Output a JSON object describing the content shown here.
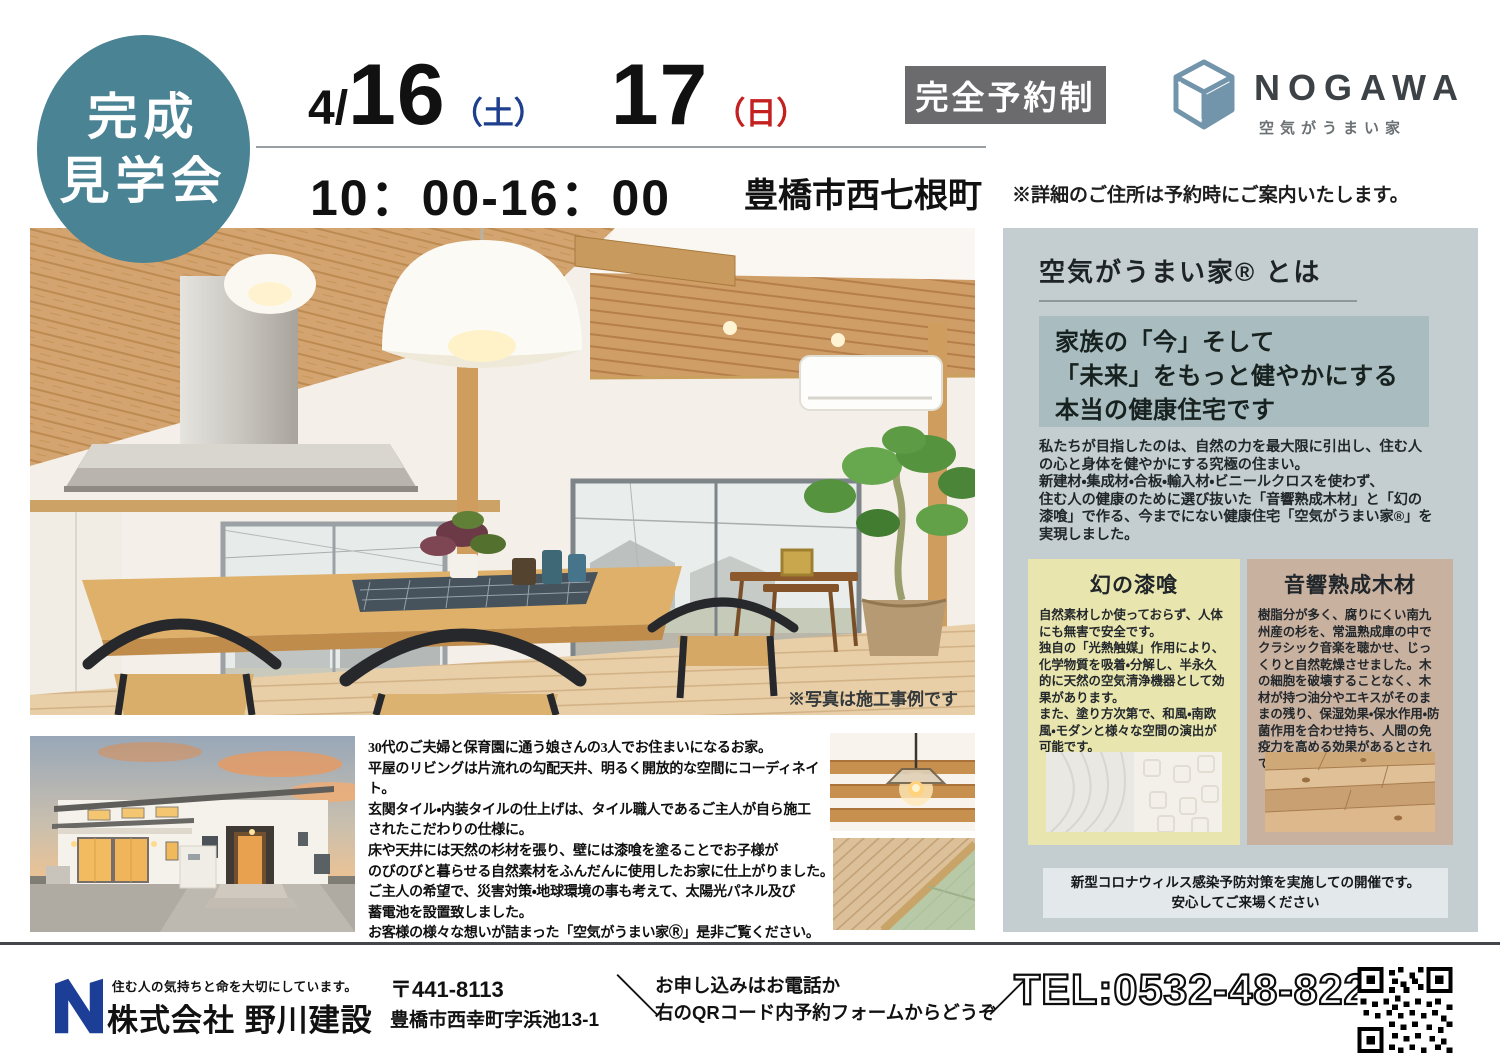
{
  "colors": {
    "teal_circle": "#4a8394",
    "saturday_blue": "#1e3f8e",
    "sunday_red": "#c4201f",
    "badge_gray": "#6b6b6d",
    "panel_bg": "#c4ced1",
    "panel_lead_bg": "#a9bdc0",
    "plaster_box": "#e9e5ae",
    "wood_box": "#c9b1a0",
    "logo_steel_blue": "#7295ab",
    "footer_navy": "#1c3e96"
  },
  "event": {
    "circle_line1": "完成",
    "circle_line2": "見学会",
    "date_month": "4/",
    "date_day1": "16",
    "date_day1_weekday": "（土）",
    "date_day2": "17",
    "date_day2_weekday": "（日）",
    "reservation_badge": "完全予約制",
    "time": "10：00-16：00",
    "location": "豊橋市西七根町",
    "location_note": "※詳細のご住所は予約時にご案内いたします。"
  },
  "logo": {
    "name": "NOGAWA",
    "tagline": "空気がうまい家",
    "icon": "nogawa-cube-icon"
  },
  "main_photo": {
    "caption": "※写真は施工事例です"
  },
  "panel": {
    "heading": "空気がうまい家®  とは",
    "lead": [
      "家族の「今」そして",
      "「未来」をもっと健やかにする",
      "本当の健康住宅です"
    ],
    "body": "私たちが目指したのは、自然の力を最大限に引出し、住む人\nの心と身体を健やかにする究極の住まい。\n新建材・集成材・合板・輸入材・ビニールクロスを使わず、\n住む人の健康のために選び抜いた「音響熟成木材」と「幻の\n漆喰」で作る、今までにない健康住宅「空気がうまい家®」を\n実現しました。",
    "materials": [
      {
        "title": "幻の漆喰",
        "body": "自然素材しか使っておらず、人体にも無害で安全です。\n独自の「光熱触媒」作用により、化学物質を吸着・分解し、半永久的に天然の空気清浄機器として効果があります。\nまた、塗り方次第で、和風・南欧風・モダンと様々な空間の演出が可能です。"
      },
      {
        "title": "音響熟成木材",
        "body": "樹脂分が多く、腐りにくい南九州産の杉を、常温熟成庫の中でクラシック音楽を聴かせ、じっくりと自然乾燥させました。木の細胞を破壊することなく、木材が持つ油分やエキスがそのままの残り、保湿効果・保水作用・防菌作用を合わせ持ち、人間の免疫力を高める効果があるとされています。"
      }
    ],
    "notice": [
      "新型コロナウィルス感染予防対策を実施しての開催です。",
      "安心してご来場ください"
    ]
  },
  "description": [
    "30代のご夫婦と保育園に通う娘さんの3人でお住まいになるお家。",
    "平屋のリビングは片流れの勾配天井、明るく開放的な空間にコーディネイト。",
    "玄関タイル・内装タイルの仕上げは、タイル職人であるご主人が自ら施工",
    "されたこだわりの仕様に。",
    "床や天井には天然の杉材を張り、壁には漆喰を塗ることでお子様が",
    "のびのびと暮らせる自然素材をふんだんに使用したお家に仕上がりました。",
    "ご主人の希望で、災害対策・地球環境の事も考えて、太陽光パネル及び",
    "蓄電池を設置致しました。",
    "お客様の様々な想いが詰まった「空気がうまい家Ⓡ」是非ご覧ください。"
  ],
  "footer": {
    "tagline": "住む人の気持ちと命を大切にしています。",
    "company": "株式会社 野川建設",
    "postal": "〒441-8113",
    "address": "豊橋市西幸町字浜池13-1",
    "cta": [
      "お申し込みはお電話か",
      "右のQRコード内予約フォームからどうぞ"
    ],
    "cta_slash_left": "＼",
    "cta_slash_right": "／",
    "tel": "TEL:0532-48-8221",
    "qr_icon": "qr-code"
  }
}
